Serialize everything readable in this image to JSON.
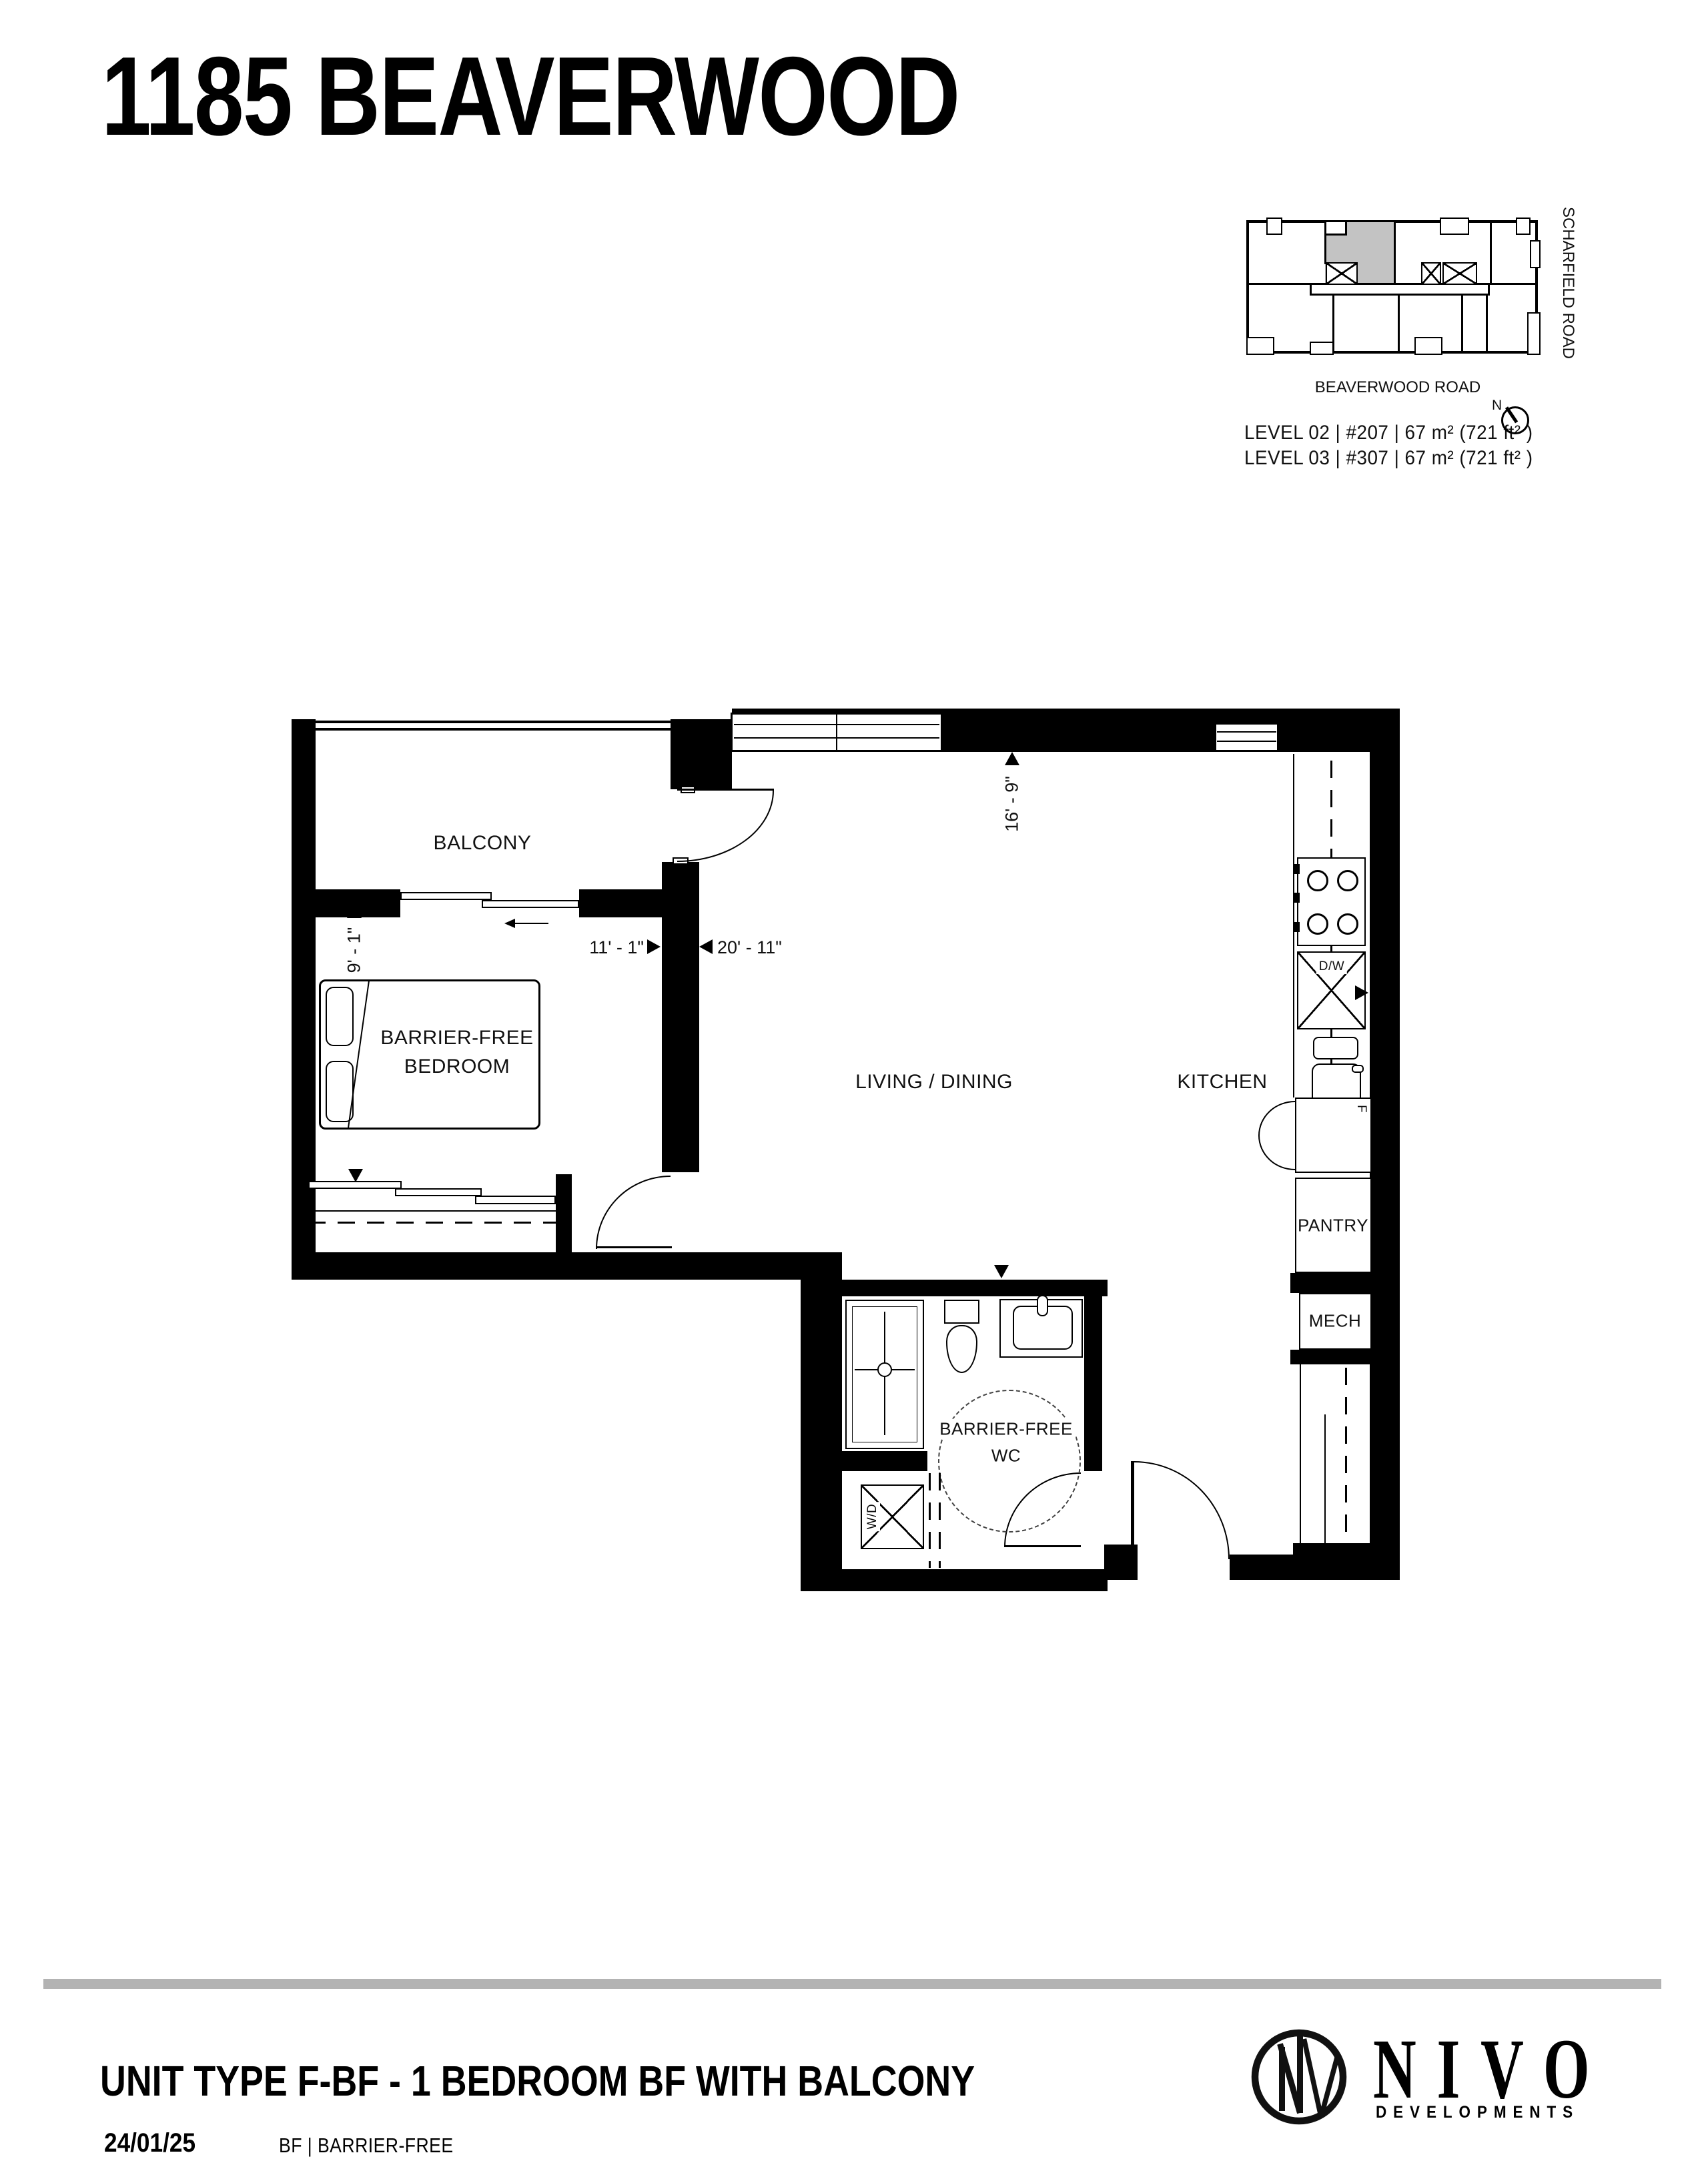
{
  "header": {
    "title": "1185 BEAVERWOOD"
  },
  "key_plan": {
    "street_right": "SCHARFIELD ROAD",
    "street_bottom": "BEAVERWOOD ROAD",
    "north_label": "N",
    "levels": [
      {
        "label": "LEVEL 02 | #207  | 67 m² (721 ft² )"
      },
      {
        "label": "LEVEL 03 | #307  | 67 m² (721 ft² )"
      }
    ],
    "highlight_color": "#c3c3c3"
  },
  "plan": {
    "rooms": {
      "balcony": "BALCONY",
      "bedroom_line1": "BARRIER-FREE",
      "bedroom_line2": "BEDROOM",
      "living": "LIVING / DINING",
      "kitchen": "KITCHEN",
      "wc_line1": "BARRIER-FREE",
      "wc_line2": "WC",
      "pantry": "PANTRY",
      "mech": "MECH"
    },
    "appliances": {
      "dishwasher": "D/W",
      "washer_dryer": "W/D",
      "fridge": "F"
    },
    "dimensions": {
      "bedroom_width": "9' - 1\"",
      "bedroom_length": "11' - 1\"",
      "living_length": "20' - 11\"",
      "living_width": "16' - 9\""
    }
  },
  "footer": {
    "unit_title": "UNIT TYPE F-BF - 1 BEDROOM BF WITH BALCONY",
    "date": "24/01/25",
    "legend": "BF | BARRIER-FREE",
    "brand": "NIVO",
    "brand_sub": "DEVELOPMENTS"
  },
  "colors": {
    "wall": "#000000",
    "unit_highlight": "#c3c3c3",
    "divider": "#b3b3b3"
  }
}
